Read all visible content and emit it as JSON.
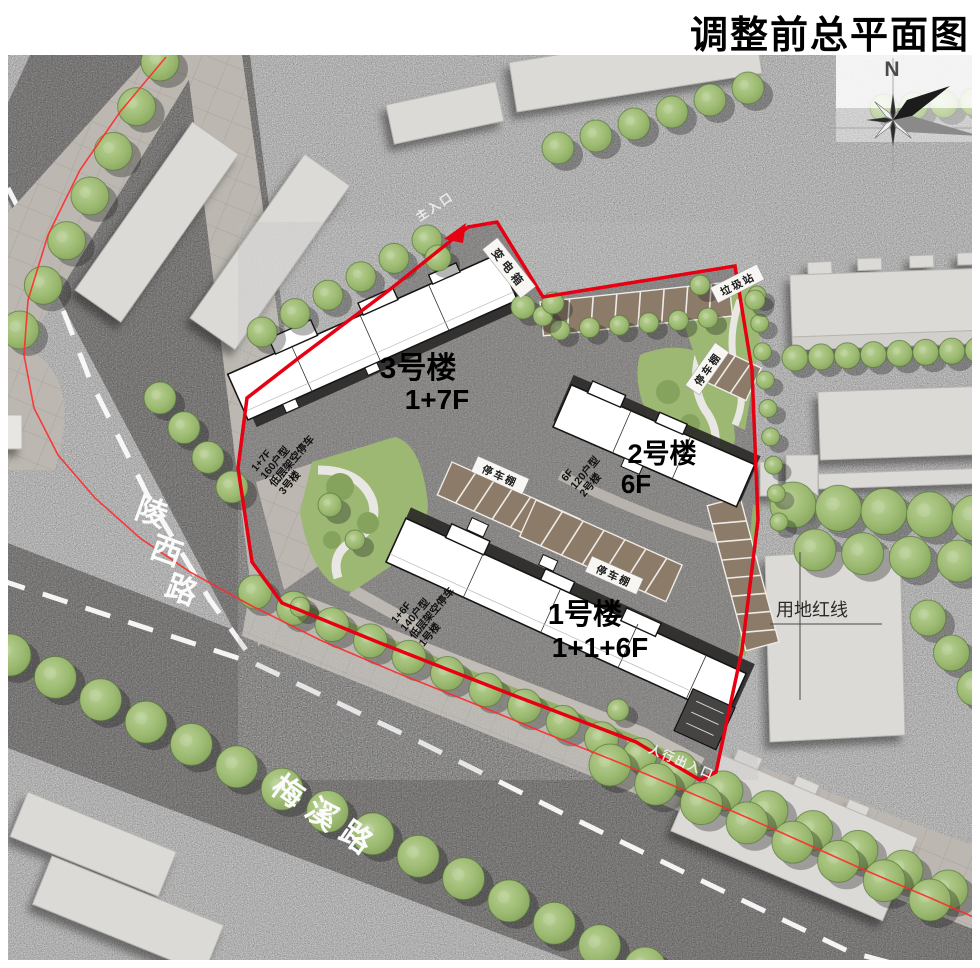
{
  "title": "调整前总平面图",
  "compass": {
    "north": "N"
  },
  "roads": [
    {
      "name": "陵西路",
      "chars": [
        "陵",
        "西",
        "路"
      ]
    },
    {
      "name": "梅溪路",
      "chars": [
        "梅",
        "溪",
        "路"
      ]
    }
  ],
  "site": {
    "boundary_label": "用地红线",
    "main_entrance": "主入口",
    "pedestrian_entrance": "人行出入口",
    "transformer": "变电箱",
    "garbage_station": "垃圾站",
    "parking_shed": "停车棚",
    "buildings": [
      {
        "name": "3号楼",
        "floors": "1+7F",
        "tags": [
          "1+7F",
          "160户型",
          "低层架空停车",
          "3号楼"
        ]
      },
      {
        "name": "2号楼",
        "floors": "6F",
        "tags": [
          "6F",
          "120户型",
          "2号楼"
        ]
      },
      {
        "name": "1号楼",
        "floors": "1+1+6F",
        "tags": [
          "1+6F",
          "140户型",
          "低层架空停车",
          "1号楼"
        ]
      }
    ]
  },
  "colors": {
    "boundary": "#e60012",
    "road_redline": "#ff2a2a",
    "tree": "#9cb873",
    "parking": "#8c7b69",
    "asphalt": "#666361",
    "road": "#4f4c4a",
    "sidewalk": "#bcb8b1",
    "site_ground": "#6f6d6a",
    "building_site": "#ffffff",
    "building_context": "#dcdad7"
  }
}
